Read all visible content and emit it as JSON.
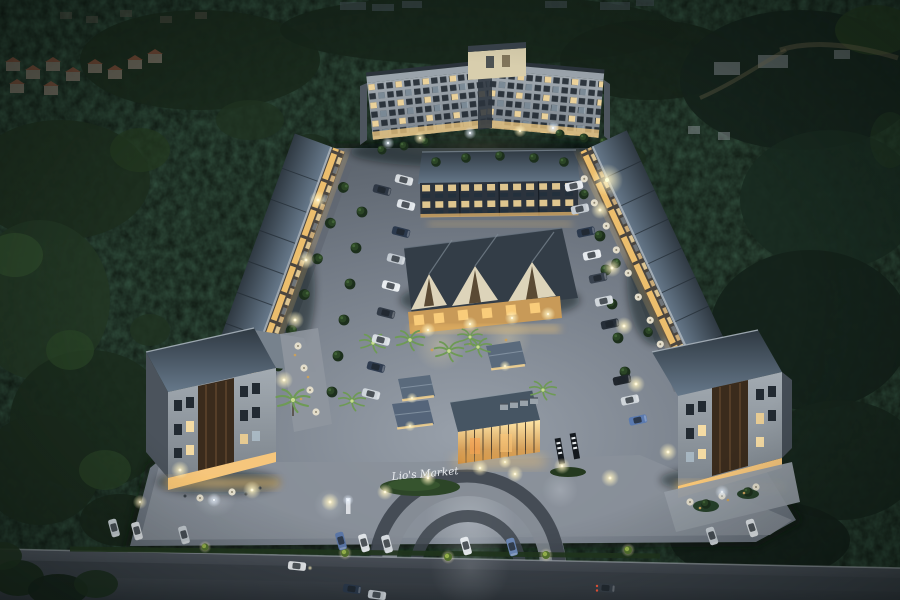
{
  "scene": {
    "description": "Aerial night-time architectural rendering of a lit mixed-use development: an 8-storey V-shaped condominium at the rear, rows of three-storey shophouses framing central gabled market halls, a glass sales pavilion, landscaped parking courts full of cars, palm trees and street lights, all surrounded by dense dark forest with a public road across the foreground.",
    "sign_text": "Lio's Market",
    "palette": {
      "forest": "#16241a",
      "pavement": "#7e8590",
      "road": "#3f454e",
      "roof_slate": "#36404a",
      "roof_light": "#6b7c8c",
      "facade": "#a7adb3",
      "warm_light": "#ffd98a",
      "cool_light": "#eef3f7",
      "amber_storefront": "#f0b65e",
      "tree_green": "#2a4527",
      "wood_panel": "#40301f"
    }
  }
}
